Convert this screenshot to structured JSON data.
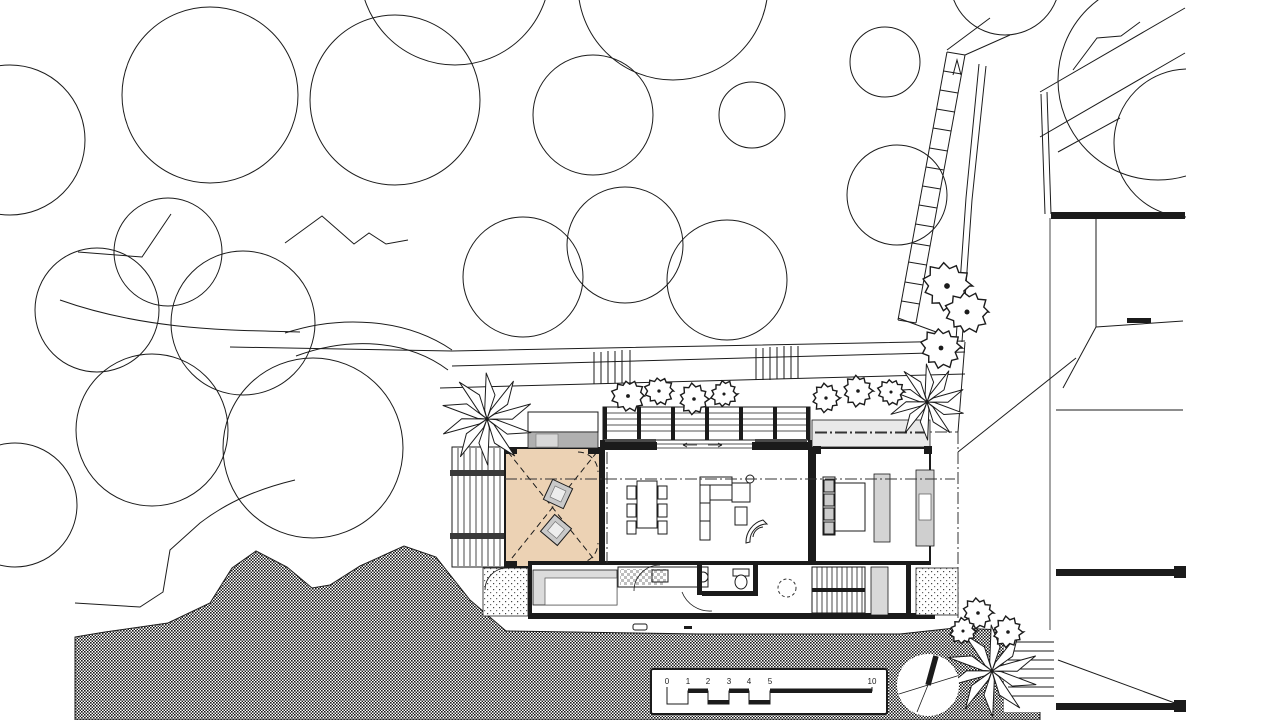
{
  "drawing": {
    "kind": "architectural-site-plan",
    "scale_bar": {
      "labels": [
        "0",
        "1",
        "2",
        "3",
        "4",
        "5",
        "10"
      ]
    },
    "north_arrow": {
      "icon": "north-arrow-icon"
    }
  },
  "colors": {
    "paper": "#ffffff",
    "line": "#1b1b1b",
    "deck_fill": "#ecd2b4",
    "roof_gray": "#b0b0b0",
    "light_gray": "#d8d8d8",
    "pale_gray": "#e9e9e9",
    "hatch_dark": "#1a1a1a"
  },
  "site": {
    "trees": [
      {
        "x": 210,
        "y": 95,
        "r": 88
      },
      {
        "x": 395,
        "y": 100,
        "r": 85
      },
      {
        "x": 455,
        "y": -30,
        "r": 95
      },
      {
        "x": 673,
        "y": -15,
        "r": 95
      },
      {
        "x": 593,
        "y": 115,
        "r": 60
      },
      {
        "x": 752,
        "y": 115,
        "r": 33
      },
      {
        "x": 885,
        "y": 62,
        "r": 35
      },
      {
        "x": 897,
        "y": 195,
        "r": 50
      },
      {
        "x": 625,
        "y": 245,
        "r": 58
      },
      {
        "x": 523,
        "y": 277,
        "r": 60
      },
      {
        "x": 727,
        "y": 280,
        "r": 60
      },
      {
        "x": 168,
        "y": 252,
        "r": 54
      },
      {
        "x": 97,
        "y": 310,
        "r": 62
      },
      {
        "x": 243,
        "y": 323,
        "r": 72
      },
      {
        "x": 313,
        "y": 448,
        "r": 90
      },
      {
        "x": 152,
        "y": 430,
        "r": 76
      },
      {
        "x": 15,
        "y": 505,
        "r": 62
      },
      {
        "x": 10,
        "y": 140,
        "r": 75
      },
      {
        "x": 1005,
        "y": -20,
        "r": 55
      }
    ],
    "trees_ne": [
      {
        "x": 1158,
        "y": 80,
        "r": 100
      },
      {
        "x": 1188,
        "y": 143,
        "r": 74
      }
    ],
    "shrubs": [
      {
        "x": 628,
        "y": 396,
        "r": 16
      },
      {
        "x": 659,
        "y": 391,
        "r": 14
      },
      {
        "x": 694,
        "y": 399,
        "r": 15
      },
      {
        "x": 724,
        "y": 394,
        "r": 13
      },
      {
        "x": 826,
        "y": 398,
        "r": 14
      },
      {
        "x": 858,
        "y": 391,
        "r": 15
      },
      {
        "x": 891,
        "y": 392,
        "r": 13
      },
      {
        "x": 947,
        "y": 286,
        "r": 24
      },
      {
        "x": 967,
        "y": 312,
        "r": 21
      },
      {
        "x": 941,
        "y": 348,
        "r": 20
      },
      {
        "x": 978,
        "y": 613,
        "r": 15
      },
      {
        "x": 963,
        "y": 631,
        "r": 13
      },
      {
        "x": 1008,
        "y": 632,
        "r": 15
      }
    ],
    "palms": [
      {
        "x": 487,
        "y": 419,
        "r": 46
      },
      {
        "x": 927,
        "y": 402,
        "r": 38
      },
      {
        "x": 992,
        "y": 671,
        "r": 46
      }
    ]
  }
}
